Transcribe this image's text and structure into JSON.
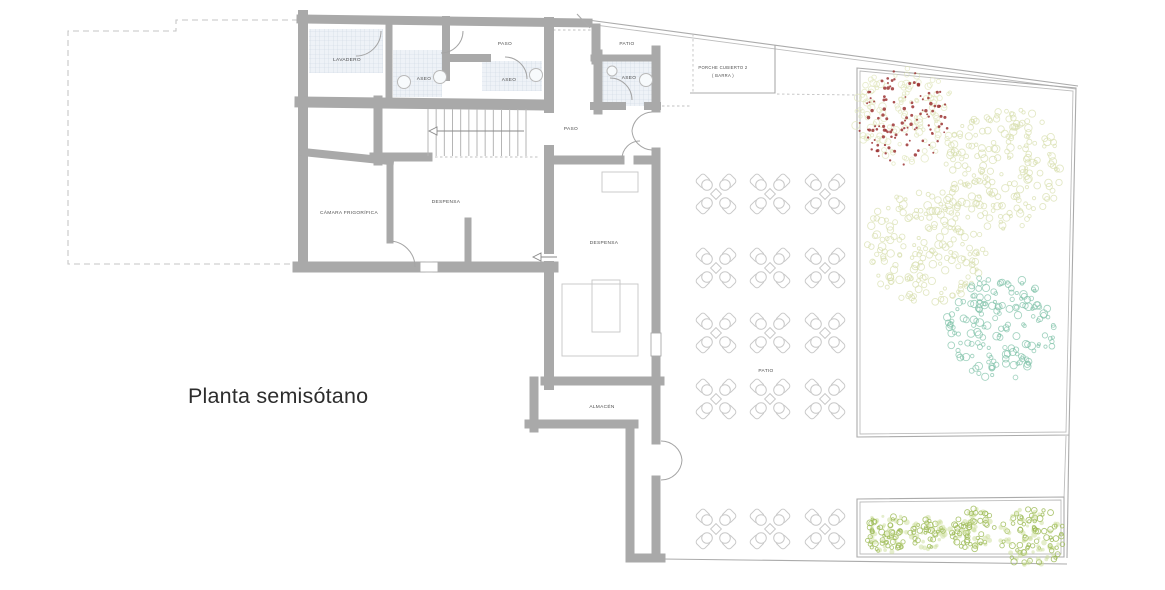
{
  "title": "Planta semisótano",
  "room_labels": [
    {
      "text": "LAVADERO",
      "x": 347,
      "y": 61,
      "size": 4.8
    },
    {
      "text": "ASEO",
      "x": 424,
      "y": 80,
      "size": 4.8
    },
    {
      "text": "PASO",
      "x": 505,
      "y": 45,
      "size": 4.8
    },
    {
      "text": "ASEO",
      "x": 509,
      "y": 81,
      "size": 4.8
    },
    {
      "text": "PATIO",
      "x": 627,
      "y": 45,
      "size": 4.8
    },
    {
      "text": "ASEO",
      "x": 629,
      "y": 79,
      "size": 4.8
    },
    {
      "text": "PORCHE CUBIERTO 2",
      "x": 723,
      "y": 69,
      "size": 4.2
    },
    {
      "text": "( BARRA )",
      "x": 723,
      "y": 77,
      "size": 4.2
    },
    {
      "text": "PASO",
      "x": 571,
      "y": 130,
      "size": 4.8
    },
    {
      "text": "CÁMARA FRIGORÍFICA",
      "x": 349,
      "y": 214,
      "size": 4.8
    },
    {
      "text": "DESPENSA",
      "x": 446,
      "y": 203,
      "size": 4.8
    },
    {
      "text": "DESPENSA",
      "x": 604,
      "y": 244,
      "size": 4.8
    },
    {
      "text": "PATIO",
      "x": 766,
      "y": 372,
      "size": 4.8
    },
    {
      "text": "ALMACÉN",
      "x": 602,
      "y": 408,
      "size": 4.8
    }
  ],
  "staircase": {
    "x1": 428,
    "x2": 526,
    "y_top": 109,
    "y_bottom": 156,
    "treads": 13,
    "arrow_y": 131
  },
  "patio_tables": {
    "cols": [
      716,
      770,
      825
    ],
    "rows": [
      194,
      268,
      333,
      399,
      529
    ]
  },
  "vegetation": [
    {
      "kind": "canopy",
      "name": "tree-red-berries",
      "cx": 905,
      "cy": 117,
      "r": 52,
      "stroke": "#e0e6bb",
      "n": 130,
      "seed": 11,
      "dots": {
        "color": "#9c3434",
        "n": 115,
        "spread": 0.93,
        "seed": 12
      }
    },
    {
      "kind": "canopy",
      "name": "tree-olive-large",
      "cx": 1004,
      "cy": 168,
      "r": 63,
      "stroke": "#d7dead",
      "n": 205,
      "seed": 21
    },
    {
      "kind": "canopy",
      "name": "tree-olive-small",
      "cx": 926,
      "cy": 247,
      "r": 61,
      "stroke": "#d7dead",
      "n": 190,
      "seed": 31
    },
    {
      "kind": "canopy",
      "name": "tree-teal",
      "cx": 1001,
      "cy": 327,
      "r": 55,
      "stroke": "#7fc2a8",
      "n": 170,
      "seed": 41
    },
    {
      "kind": "bush",
      "name": "bush-1",
      "cx": 887,
      "cy": 532,
      "r": 23,
      "stroke": "#9cba55",
      "fillc": "#ccdd99",
      "n": 80,
      "seed": 51
    },
    {
      "kind": "bush",
      "name": "bush-2",
      "cx": 928,
      "cy": 533,
      "r": 18,
      "stroke": "#9cba55",
      "fillc": "#ccdd99",
      "n": 58,
      "seed": 61
    },
    {
      "kind": "bush",
      "name": "bush-3",
      "cx": 972,
      "cy": 529,
      "r": 23,
      "stroke": "#9cba55",
      "fillc": "#ccdd99",
      "n": 80,
      "seed": 71
    },
    {
      "kind": "bush",
      "name": "bush-4",
      "cx": 1032,
      "cy": 537,
      "r": 33,
      "stroke": "#9cba55",
      "fillc": "#ccdd99",
      "n": 120,
      "seed": 81
    }
  ],
  "colors": {
    "wall": "#a9a9a9",
    "thin_line": "#ababab",
    "dashed_line": "#c6c6c6",
    "label": "#4d4d4d",
    "chair": "#c9c9c9",
    "tile_bg": "#eef2f7",
    "tile_line": "#cdd7e2",
    "olive_canopy": "#d7dead",
    "red_dot": "#9c3434",
    "teal_canopy": "#7fc2a8",
    "bush_green": "#9cba55",
    "title_color": "#2d2d2d"
  }
}
